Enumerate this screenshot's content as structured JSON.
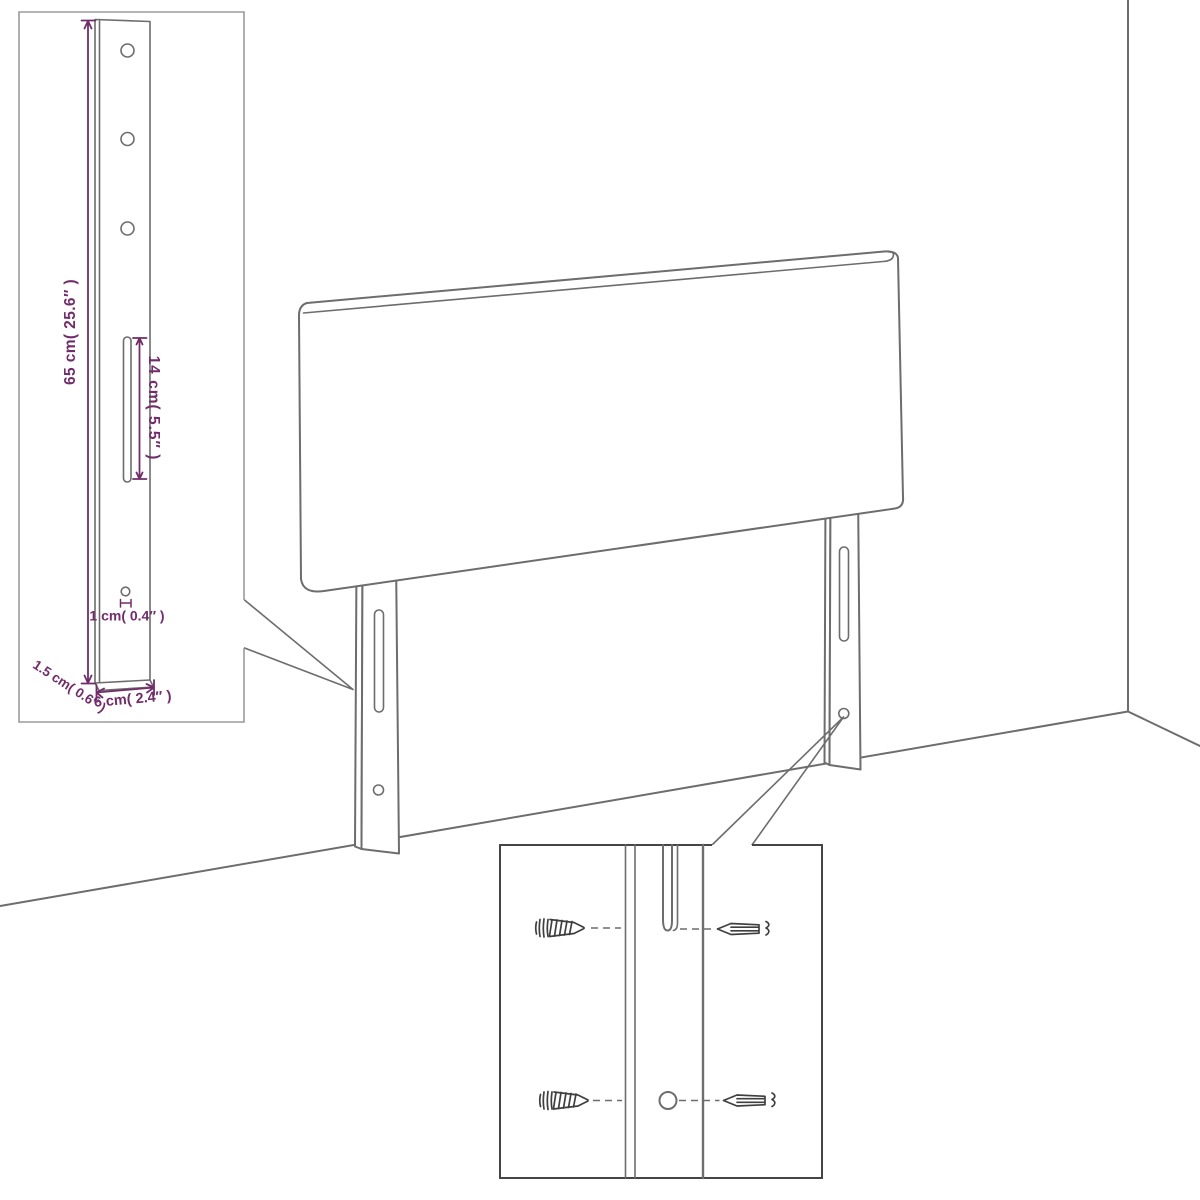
{
  "colors": {
    "background": "#ffffff",
    "outline": "#6d6d6d",
    "dimension": "#712d6a",
    "inset1": "#9b9b9b",
    "inset2": "#454545",
    "screw": "#3f3f3f"
  },
  "bracket_inset": {
    "height_label": "65 cm( 25.6″ )",
    "slot_label": "14 cm( 5.5″ )",
    "hole_label": "1 cm( 0.4″ )",
    "thickness_label": "1.5 cm( 0.6″ )",
    "width_label": "6 cm( 2.4″ )"
  },
  "mount_inset": {
    "left_screw_icon": "wood-screw-icon",
    "right_screw_icon": "mounting-screw-icon"
  }
}
